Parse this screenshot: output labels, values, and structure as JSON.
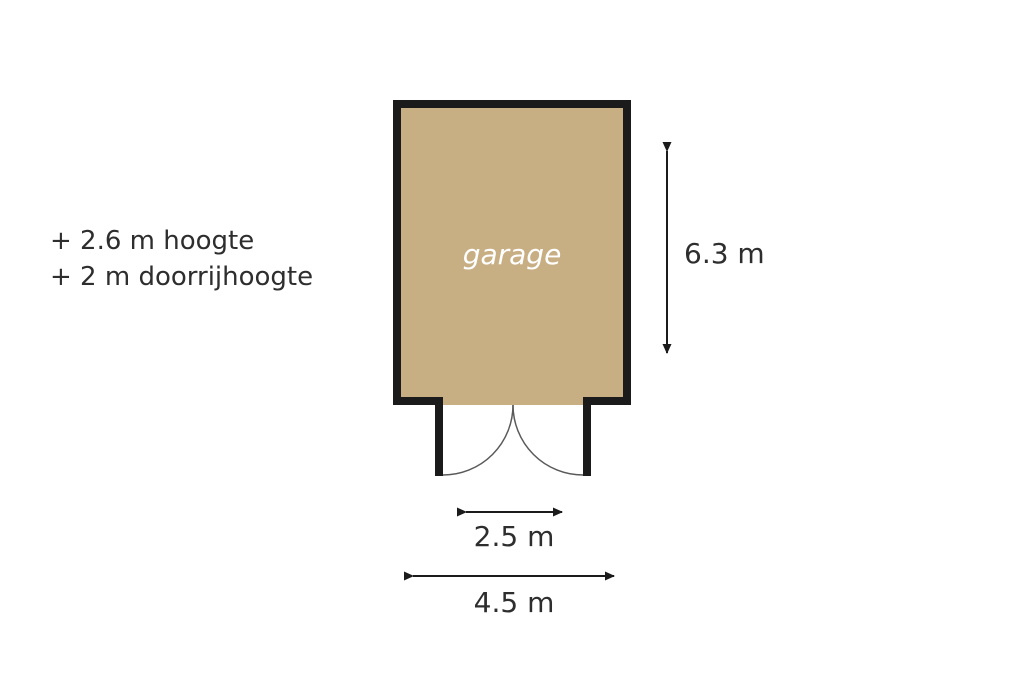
{
  "colors": {
    "background": "#ffffff",
    "floor_fill": "#c8ae83",
    "wall": "#1b1b1b",
    "text": "#2e2e2e",
    "room_label_text": "#ffffff",
    "door_arc": "#5a5a5a"
  },
  "annotations": {
    "lines": [
      "+ 2.6 m hoogte",
      "+ 2 m doorrijhoogte"
    ]
  },
  "room": {
    "label": "garage"
  },
  "dimensions": {
    "height": "6.3 m",
    "door_width": "2.5 m",
    "width": "4.5 m"
  }
}
